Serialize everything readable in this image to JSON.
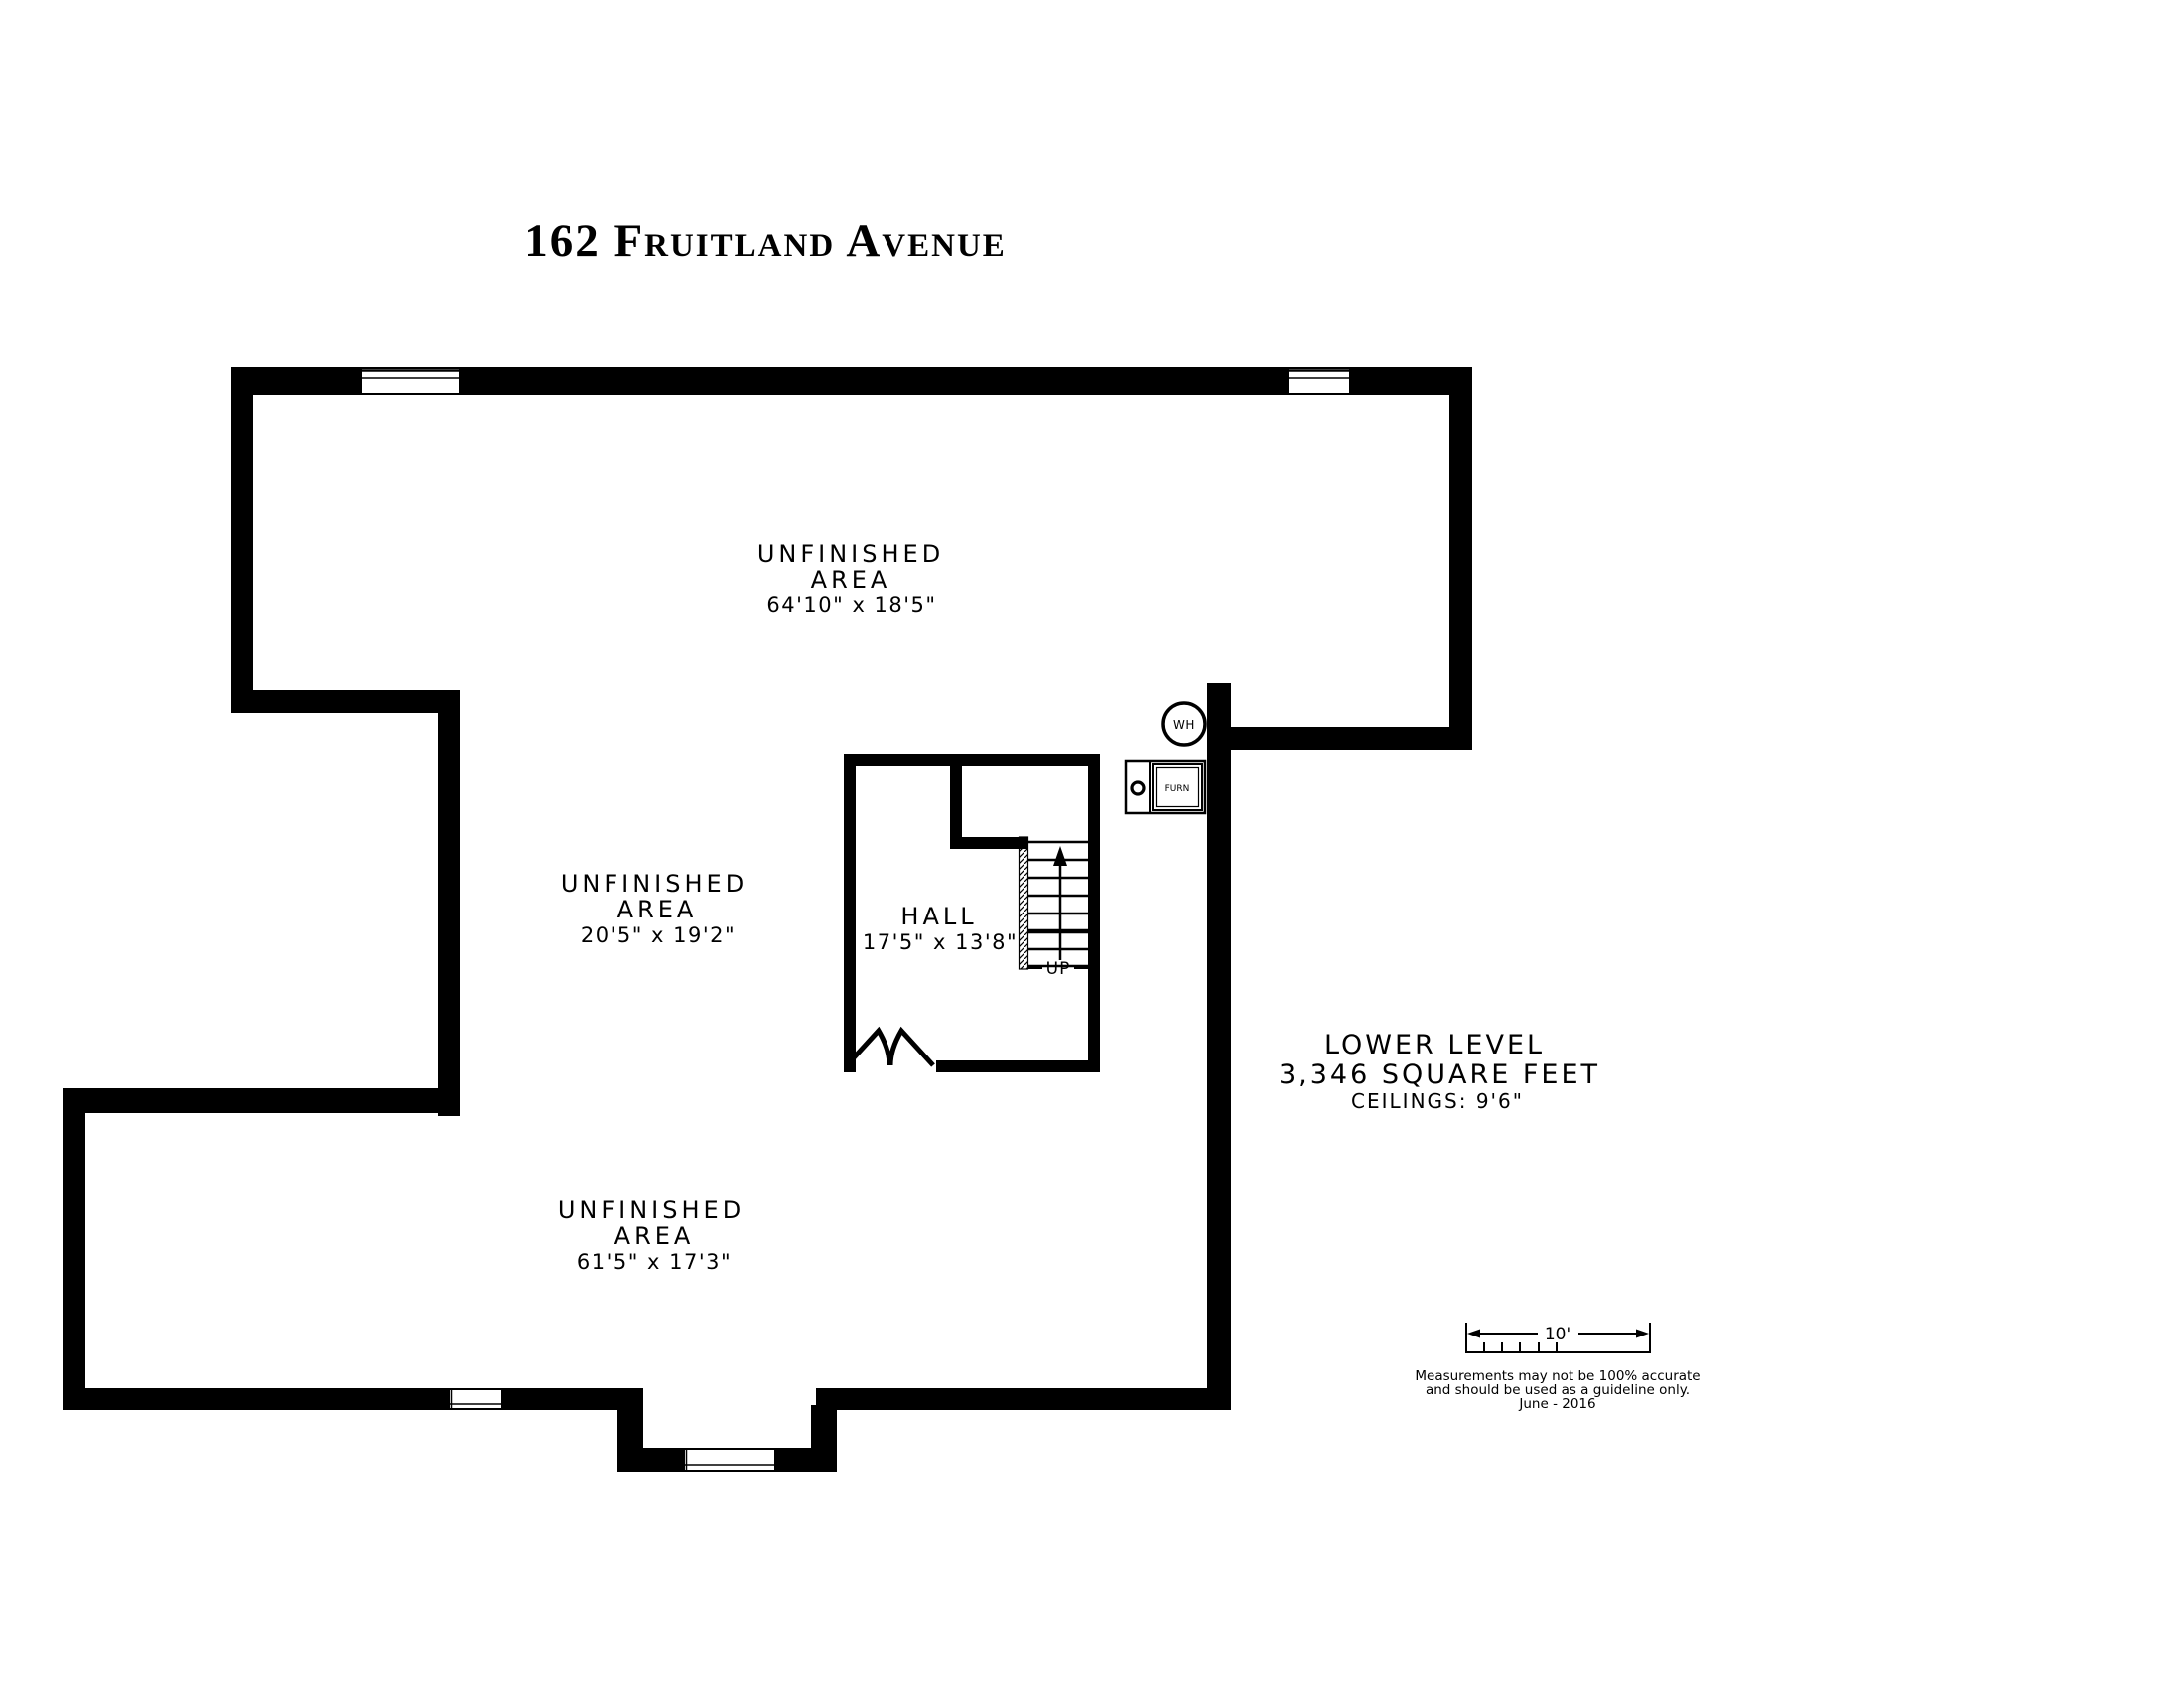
{
  "title": "162 Fruitland Avenue",
  "rooms": {
    "top": {
      "name_line1": "UNFINISHED",
      "name_line2": "AREA",
      "dimensions": "64'10\" x 18'5\""
    },
    "middle": {
      "name_line1": "UNFINISHED",
      "name_line2": "AREA",
      "dimensions": "20'5\" x 19'2\""
    },
    "hall": {
      "name": "HALL",
      "dimensions": "17'5\" x 13'8\""
    },
    "bottom": {
      "name_line1": "UNFINISHED",
      "name_line2": "AREA",
      "dimensions": "61'5\" x 17'3\""
    }
  },
  "summary": {
    "level": "LOWER LEVEL",
    "area": "3,346 SQUARE FEET",
    "ceilings": "CEILINGS: 9'6\""
  },
  "stairs": {
    "direction_label": "UP"
  },
  "equipment": {
    "water_heater_label": "WH",
    "furnace_label": "FURN"
  },
  "scale_bar": {
    "length_label": "10'"
  },
  "disclaimer": {
    "line1": "Measurements may not be 100% accurate",
    "line2": "and should be used as a guideline only.",
    "line3": "June - 2016"
  },
  "colors": {
    "walls": "#000000",
    "background": "#ffffff",
    "text": "#000000"
  }
}
